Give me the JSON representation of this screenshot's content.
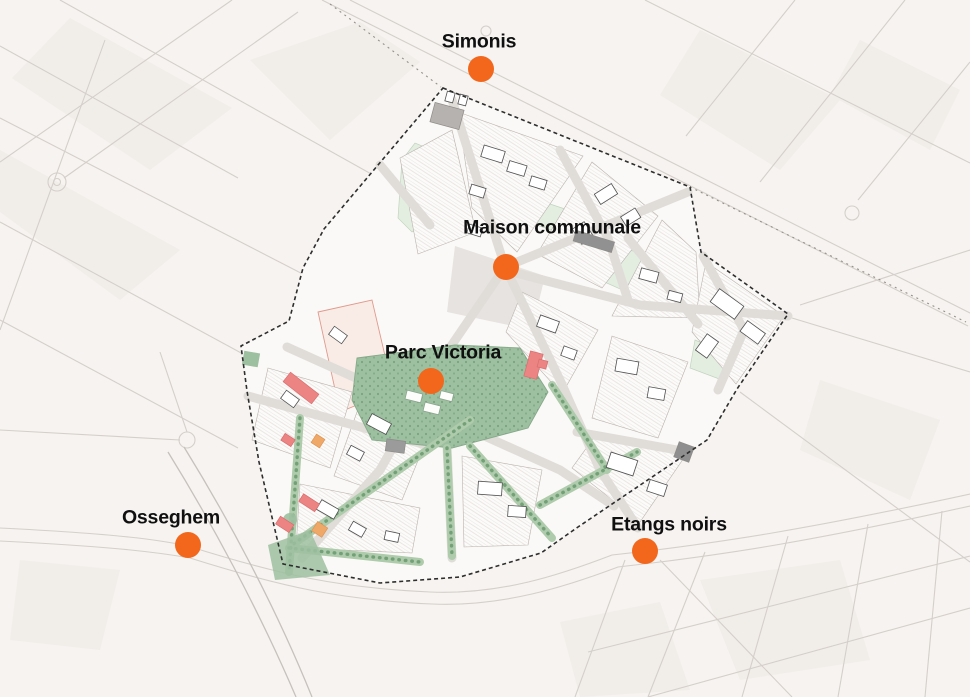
{
  "map": {
    "type": "static-urban-plan-map",
    "markers": [
      {
        "label": "Simonis",
        "x": 481,
        "y": 69,
        "label_x": 479,
        "label_y": 42
      },
      {
        "label": "Maison communale",
        "x": 506,
        "y": 267,
        "label_x": 552,
        "label_y": 228
      },
      {
        "label": "Parc Victoria",
        "x": 431,
        "y": 381,
        "label_x": 443,
        "label_y": 353
      },
      {
        "label": "Osseghem",
        "x": 188,
        "y": 545,
        "label_x": 171,
        "label_y": 518
      },
      {
        "label": "Etangs noirs",
        "x": 645,
        "y": 551,
        "label_x": 669,
        "label_y": 525
      }
    ],
    "colors": {
      "marker_orange": "#F2671C",
      "label_black": "#101010",
      "boundary_dark": "#2E2E2E",
      "park_green": "#9DC0A0",
      "corridor_green": "#A9C7A8",
      "building_red": "#EC8484",
      "accent_orange": "#F0A868",
      "background": "#F6F3F0"
    }
  }
}
